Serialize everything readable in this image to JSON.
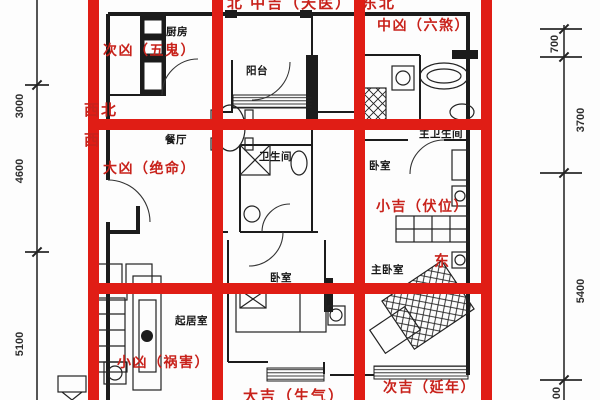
{
  "figure": {
    "type": "fengshui-floorplan-diagram",
    "palette": {
      "grid_red": "#e01d15",
      "label_red": "#c8221b",
      "wall_black": "#1c1c1c",
      "background": "#ffffff"
    }
  },
  "fengshui_labels": {
    "top_center": "北 中吉（天医）",
    "top_right_direction": "东北",
    "top_right_rating": "中凶（六煞）",
    "left_upper_rating": "次凶（五鬼）",
    "left_upper_direction": "西北",
    "left_middle_direction": "西",
    "left_middle_rating": "大凶（绝命）",
    "right_middle_rating": "小吉（伏位）",
    "right_middle_direction": "东",
    "bottom_left_rating": "小凶（祸害）",
    "bottom_center_rating": "大吉（生气）",
    "bottom_right_rating": "次吉（延年）"
  },
  "room_labels": {
    "kitchen": "厨房",
    "balcony": "阳台",
    "dining_room": "餐厅",
    "bathroom": "卫生间",
    "master_bathroom": "主卫生间",
    "bedroom_upper": "卧室",
    "master_bedroom": "主卧室",
    "bedroom_lower": "卧室",
    "living_room": "起居室"
  },
  "dimensions": {
    "left": [
      "3000",
      "4600",
      "5100"
    ],
    "right": [
      "700",
      "3700",
      "5400",
      "00"
    ]
  }
}
